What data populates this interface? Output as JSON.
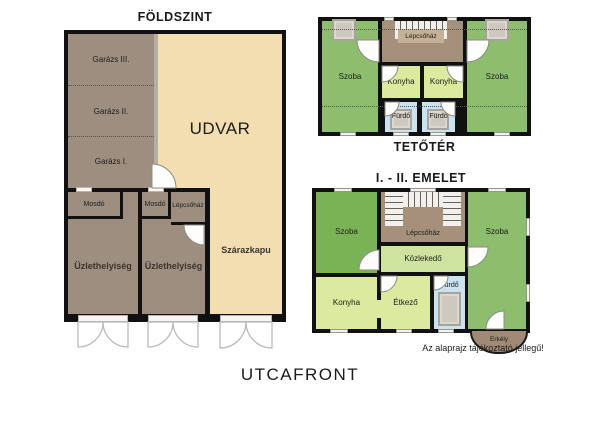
{
  "ground_floor": {
    "title": "FÖLDSZINT",
    "rooms": {
      "garage3": "Garázs III.",
      "garage2": "Garázs II.",
      "garage1": "Garázs I.",
      "udvar": "UDVAR",
      "mosdo_left": "Mosdó",
      "mosdo_right": "Mosdó",
      "lepcsohaz": "Lépcsőház",
      "uzlet_left": "Üzlethelyiség",
      "uzlet_right": "Üzlethelyiség",
      "szarazkapu": "Szárazkapu"
    }
  },
  "attic": {
    "title": "TETŐTÉR",
    "rooms": {
      "szoba_left": "Szoba",
      "szoba_right": "Szoba",
      "lepcsohaz": "Lépcsőház",
      "konyha_left": "Konyha",
      "konyha_right": "Konyha",
      "furdo_left": "Fürdő",
      "furdo_right": "Fürdő"
    }
  },
  "upper_floors": {
    "title": "I. - II. EMELET",
    "rooms": {
      "szoba_left": "Szoba",
      "szoba_right": "Szoba",
      "lepcsohaz": "Lépcsőház",
      "kozlekedo": "Közlekedő",
      "konyha": "Konyha",
      "etkezo": "Étkező",
      "furdo": "Fürdő",
      "erkely": "Erkély"
    }
  },
  "footer": {
    "street_label": "UTCAFRONT",
    "disclaimer": "Az alaprajz tájékoztató jellegű!"
  },
  "colors": {
    "wall": "#111111",
    "garage_brown": "#9d8e80",
    "courtyard_tan": "#f3deb1",
    "room_green": "#8cbe6e",
    "room_green_dark": "#79b356",
    "room_pale_green": "#dcea9f",
    "corridor_green": "#cfe3a0",
    "bathroom_blue": "#c9e3f0",
    "stair_brown": "#a5907c",
    "stair_label_patch": "#c4b197",
    "balcony_brown": "#a18a75",
    "fixture_gray": "#cdc9c0"
  }
}
